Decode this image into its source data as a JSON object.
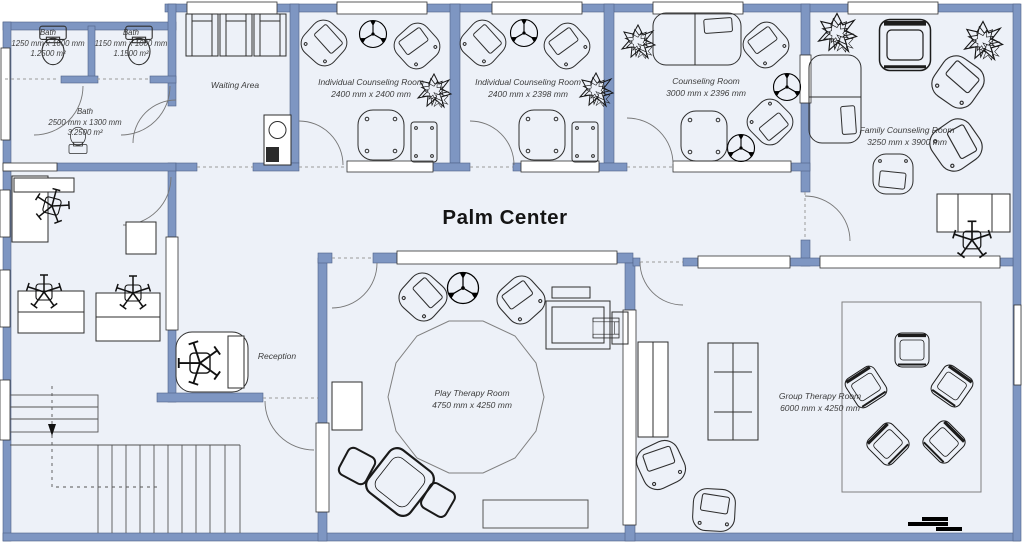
{
  "title": "Palm Center",
  "rooms": {
    "bath_a": {
      "name": "Bath",
      "dimensions": "1250 mm x 1000 mm",
      "area": "1.2500 m²"
    },
    "bath_b": {
      "name": "Bath",
      "dimensions": "1150 mm x 1000 mm",
      "area": "1.1500 m²"
    },
    "bath_main": {
      "name": "Bath",
      "dimensions": "2500 mm x 1300 mm",
      "area": "3.2500 m²"
    },
    "waiting_area": {
      "name": "Waiting Area"
    },
    "individual_counseling_1": {
      "name": "Individual Counseling Room",
      "dimensions": "2400 mm x 2400 mm"
    },
    "individual_counseling_2": {
      "name": "Individual Counseling Room",
      "dimensions": "2400 mm x 2398 mm"
    },
    "counseling": {
      "name": "Counseling Room",
      "dimensions": "3000 mm x 2396 mm"
    },
    "family_counseling": {
      "name": "Family Counseling Room",
      "dimensions": "3250 mm x 3900 mm"
    },
    "reception": {
      "name": "Reception"
    },
    "play_therapy": {
      "name": "Play Therapy Room",
      "dimensions": "4750 mm x 4250 mm"
    },
    "group_therapy": {
      "name": "Group Therapy Room",
      "dimensions": "6000 mm x 4250 mm"
    }
  },
  "colors": {
    "wall": "#7e96c2",
    "floor": "#edf1f8",
    "window": "#ffffff",
    "outline": "#2e2e2e"
  },
  "icons": {
    "ceiling_fan": "ceiling-fan-icon",
    "plant": "plant-icon",
    "toilet": "toilet-icon",
    "stairs": "stairs-icon",
    "scale_bar": "scale-bar-icon"
  }
}
